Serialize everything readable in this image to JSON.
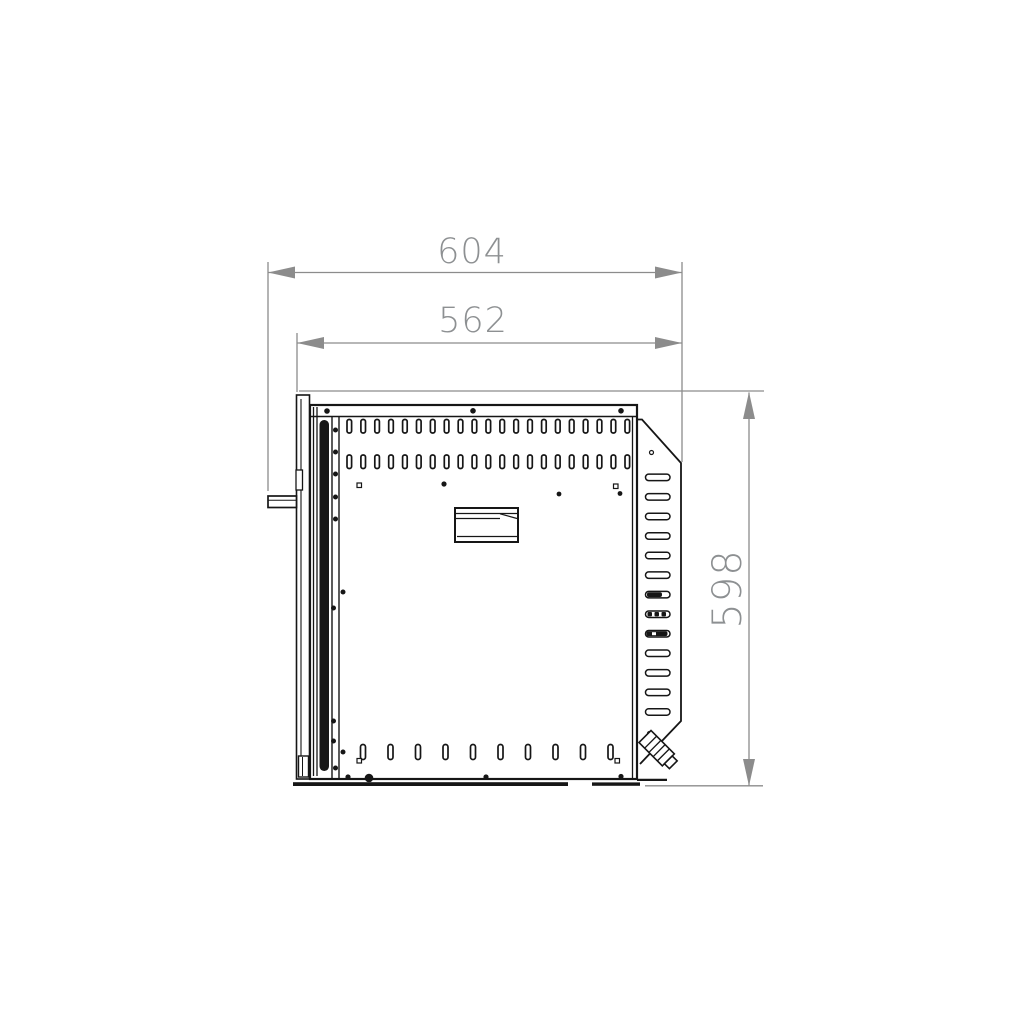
{
  "drawing": {
    "type": "technical-dimension-drawing",
    "view": "appliance side elevation",
    "dimensions": [
      {
        "id": "overall-depth",
        "value": "604",
        "orientation": "horizontal",
        "position": "top-outer"
      },
      {
        "id": "body-depth",
        "value": "562",
        "orientation": "horizontal",
        "position": "top-inner"
      },
      {
        "id": "overall-height",
        "value": "598",
        "orientation": "vertical",
        "position": "right"
      }
    ],
    "colors": {
      "background": "#ffffff",
      "line": "#161616",
      "dimension_line": "#8c8c8c",
      "dimension_text": "#8d9092"
    },
    "features": {
      "top_slot_rows": 2,
      "top_slots_per_row": 21,
      "bottom_slots": 10,
      "side_vent_slots": 13,
      "side_vent_dark_slots": [
        7,
        8,
        9
      ],
      "has_door_handle": true,
      "has_nameplate": true,
      "has_corner_cable_gland": true
    }
  }
}
